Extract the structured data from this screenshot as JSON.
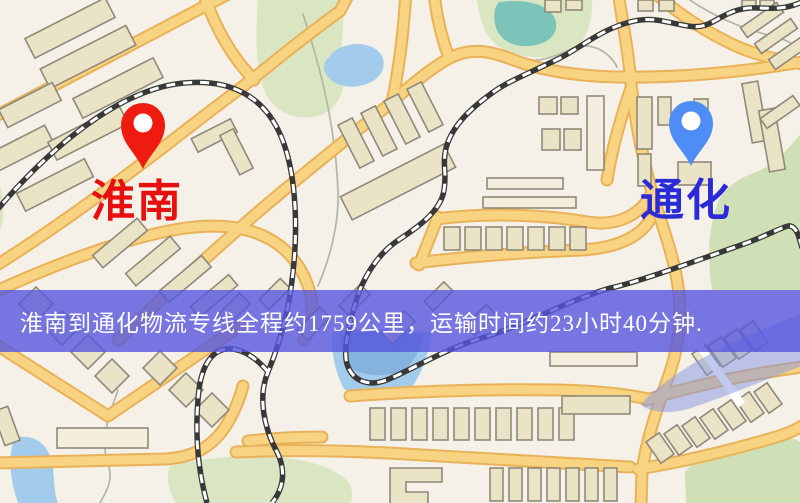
{
  "banner": {
    "text": "淮南到通化物流专线全程约1759公里，运输时间约23小时40分钟.",
    "bg_color": "rgba(86,86,222,0.8)",
    "text_color": "#ffffff"
  },
  "markers": {
    "origin": {
      "label": "淮南",
      "label_color": "#e80f0f",
      "pin_color": "#f01b10",
      "pin_icon": "map-pin"
    },
    "destination": {
      "label": "通化",
      "label_color": "#2a2ad6",
      "pin_color": "#4e8df5",
      "pin_icon": "map-pin"
    }
  },
  "map_colors": {
    "background": "#f5f1e8",
    "road_fill": "#f8d382",
    "road_casing": "#e9b258",
    "building": "#ebe3c6",
    "building_outline": "#8f897b",
    "park_green": "#d9e6c1",
    "water_blue": "#a3cbec",
    "pond_teal": "#7cc3ba",
    "railway_dark": "#383838",
    "river_overlay": "#8193e2"
  }
}
